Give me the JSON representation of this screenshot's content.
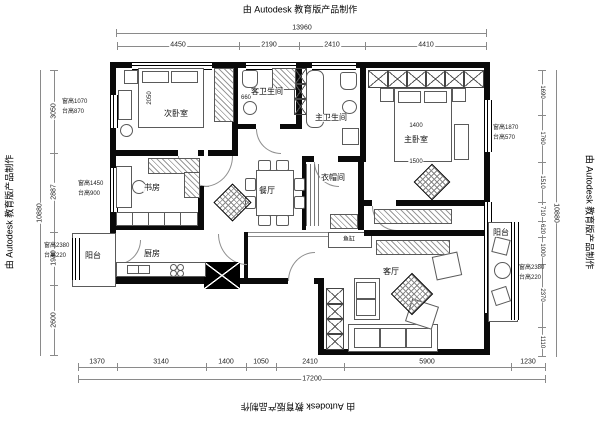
{
  "titles": {
    "top": "由 Autodesk 教育版产品制作",
    "bottom": "由 Autodesk 教育版产品制作",
    "left": "由 Autodesk 教育版产品制作",
    "right": "由 Autodesk 教育版产品制作"
  },
  "rooms": {
    "secondary_bedroom": "次卧室",
    "study": "书房",
    "guest_bathroom": "客卫生间",
    "master_bathroom": "主卫生间",
    "master_bedroom": "主卧室",
    "dining": "餐厅",
    "cloakroom": "衣帽间",
    "kitchen": "厨房",
    "balcony_left": "阳台",
    "balcony_right": "阳台",
    "living": "客厅",
    "fish_tank": "鱼缸"
  },
  "dims": {
    "top": {
      "total": "13960",
      "segments": [
        "4450",
        "2190",
        "2410",
        "4410"
      ]
    },
    "bottom": {
      "total": "17200",
      "segments": [
        "1370",
        "3140",
        "1400",
        "1050",
        "2410",
        "5900",
        "1230"
      ]
    },
    "left": {
      "total": "10880",
      "segments": [
        "3050",
        "2887",
        "1940",
        "2600"
      ]
    },
    "right": {
      "total": "10880",
      "segments": [
        "1690",
        "1760",
        "1510",
        "710",
        "620",
        "1000",
        "2370",
        "1110"
      ]
    }
  },
  "interior_dims": {
    "bedroom2_width": "2050",
    "guest_bath_width": "660",
    "bed_width": "1400",
    "bed_length": "1500"
  },
  "annotations": {
    "left_top": {
      "line1": "窗高1070",
      "line2": "台高870"
    },
    "left_mid": {
      "line1": "窗高1450",
      "line2": "台高900"
    },
    "left_bottom": {
      "line1": "窗高2380",
      "line2": "台高220"
    },
    "right_top": {
      "line1": "窗高1870",
      "line2": "台高570"
    },
    "right_mid": {
      "line1": "窗高2380",
      "line2": "台高220"
    }
  }
}
